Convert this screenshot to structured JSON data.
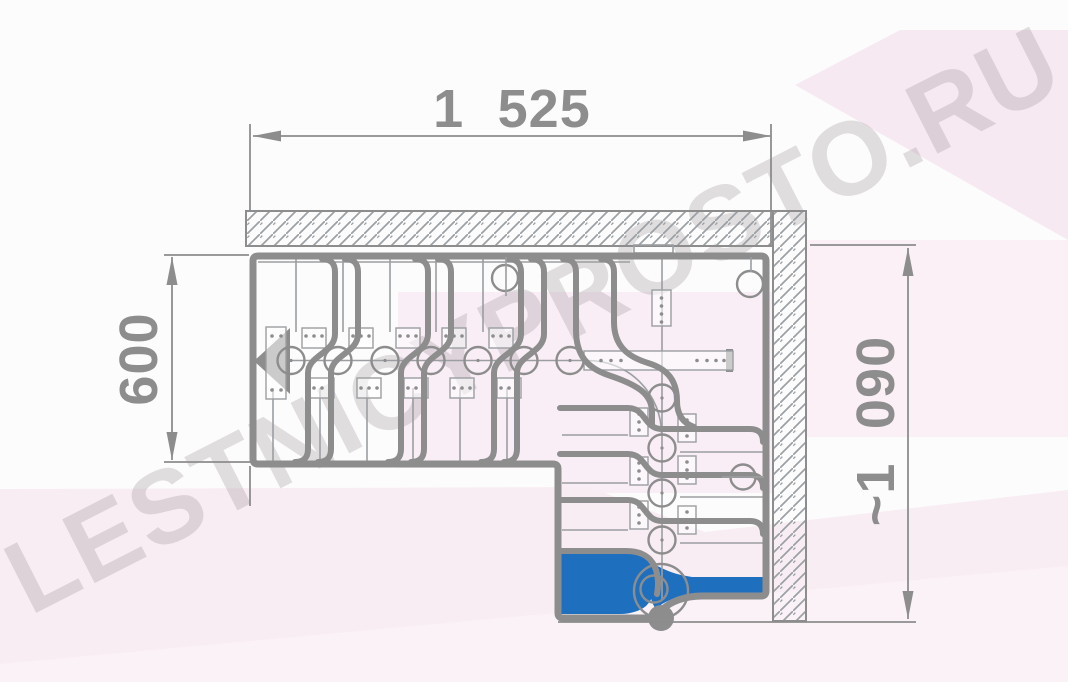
{
  "watermark": {
    "text": "LESTNICYPROSTO.RU"
  },
  "dimensions": {
    "top": {
      "label": "1 525",
      "orientation": "horizontal",
      "measures": "stair flight length along top wall"
    },
    "left": {
      "label": "600",
      "orientation": "vertical",
      "measures": "stair flight width"
    },
    "right": {
      "label": "~1 090",
      "orientation": "vertical",
      "measures": "overall depth of stair with quarter turn"
    }
  },
  "drawing": {
    "kind": "floor plan of an L-shaped modular staircase with quarter turn",
    "first_step_highlighted": true
  },
  "colors": {
    "accent": "#1e70bf",
    "line": "#8d8d8d",
    "thin": "#9b9ea1",
    "dim": "#8d8d8d",
    "hatch": "#9aa0a4",
    "pink-top": "#f6e9f1",
    "pink-top2": "#faf0f6",
    "pink-mid": "#f9eef5",
    "pink-bottom": "#f8edf3",
    "pink-light": "#fbf2f7",
    "watermark": "rgba(158,148,156,0.30)"
  }
}
